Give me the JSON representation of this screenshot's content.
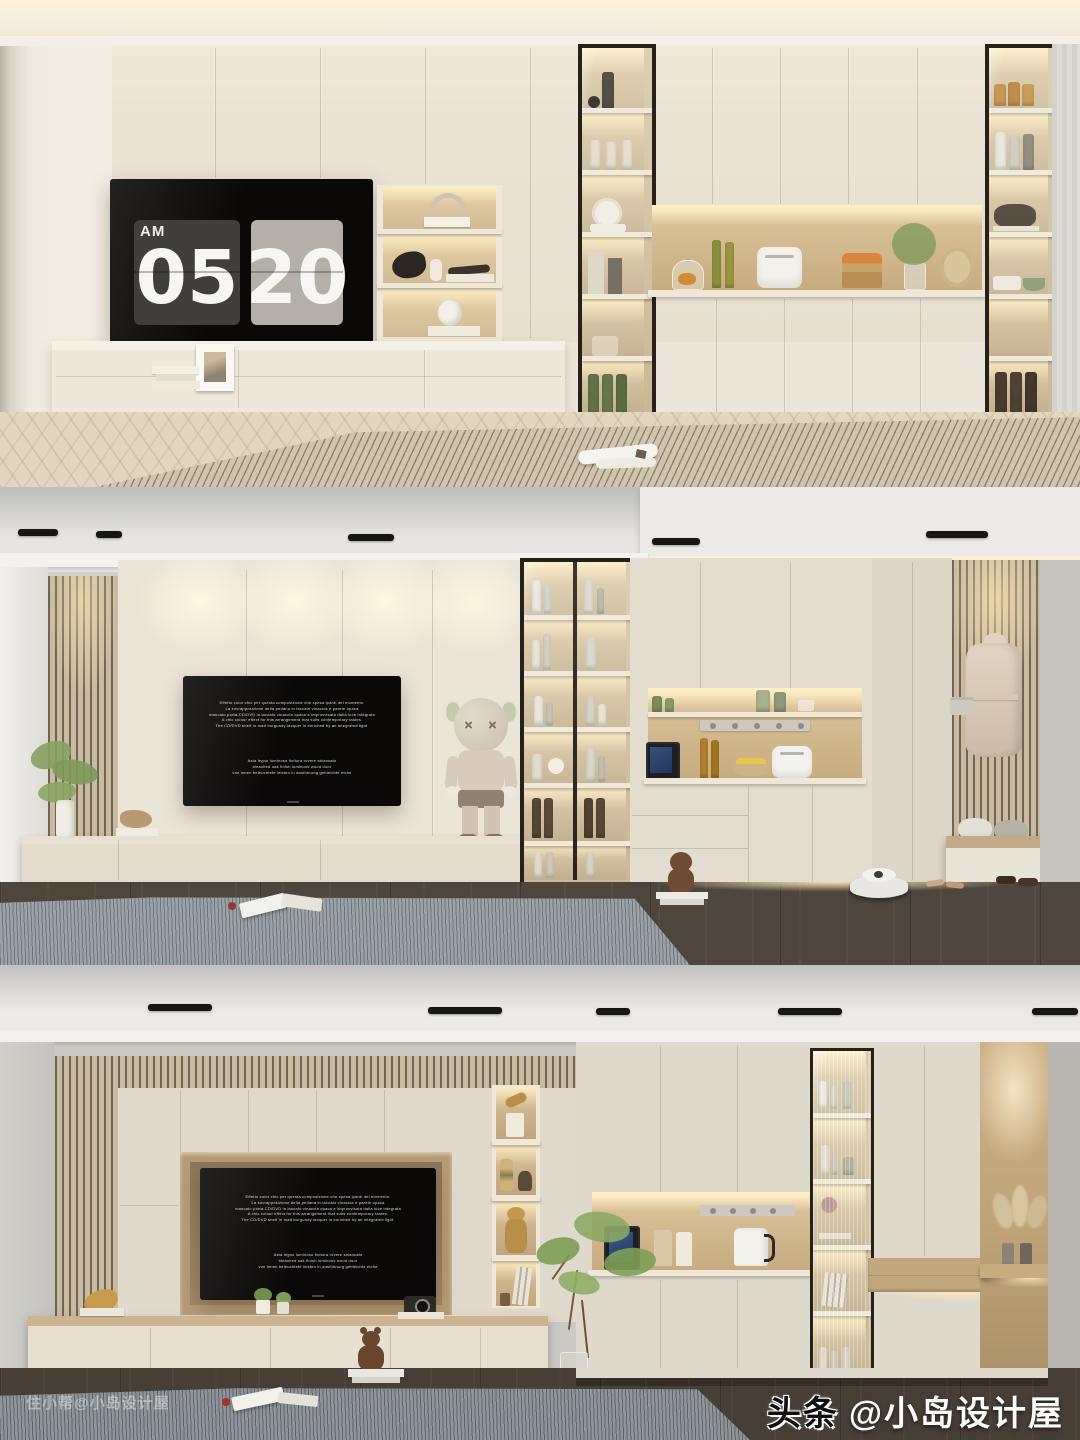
{
  "page": {
    "description": "Three stacked interior renders of modern cream TV-wall cabinetry with lit display niches",
    "panels": 3
  },
  "clock": {
    "meridiem": "AM",
    "hour": "05",
    "minute": "20"
  },
  "tv_caption": {
    "block1": [
      "Effetto color chic per questa composizione che spesa ipardi del momento.",
      "La sovrapposizione della pedana in laccato vinaccia e parete opaca",
      "mancato porta-CD/DVD in laccato vinaccia opaca e improvvisata dalla luce integrata",
      "A chic colour effect for this arrangement that suits contemporary tastes.",
      "The CD/DVD shelf in matt burgundy lacquer is enriched by an integrated light."
    ],
    "block2": [
      "Asta legno luminoso finitura rovere sbiancato",
      "bleached oak finish luminous wood door",
      "von innen beleuchtete leisten in ausführung gebleichte eiche"
    ]
  },
  "watermarks": {
    "bottom_left": "住小帮@小岛设计屋",
    "bottom_right_brand": "头条",
    "bottom_right_handle": "@小岛设计屋"
  },
  "colors": {
    "cream_cabinet": "#eae3d4",
    "warm_wood": "#cfb58d",
    "accent_glow": "#ffe9bc",
    "ceiling_gray": "#d8d7d5",
    "dark_floor": "#4a4138",
    "rug_gray": "#9aa1a7",
    "rug_beige": "#d2c5ae",
    "tv_black": "#0a0908",
    "cabinet_frame": "#26211b",
    "clock_card_dark": "#413f3b",
    "clock_card_light": "#b4b0a9"
  },
  "scene": {
    "top_panel": [
      "flip-clock-tv",
      "lit-display-shelves",
      "glass-wine-cabinet",
      "appliance-niche",
      "glass-display-cabinet",
      "floating-console",
      "herringbone-floor",
      "striped-rug",
      "magazine"
    ],
    "middle_panel": [
      "wood-slat-accent",
      "wall-washer-lights",
      "tv-with-caption",
      "kaws-figure",
      "floating-console",
      "plant",
      "glass-display-cabinet",
      "appliance-niche",
      "coat-niche-with-robe",
      "bench-with-pillows",
      "robot-vacuum",
      "high-heels",
      "loafers",
      "teddy-bear",
      "gray-rug"
    ],
    "bottom_panel": [
      "wood-slat-frame",
      "recessed-tv-niche",
      "lit-display-column",
      "appliance-niche",
      "fluted-glass-cabinet",
      "wood-accent-panel",
      "pampas-vases",
      "floating-console",
      "camera-decor",
      "succulents",
      "gold-sculpture",
      "indoor-tree",
      "teddy-bear",
      "gray-rug"
    ]
  }
}
